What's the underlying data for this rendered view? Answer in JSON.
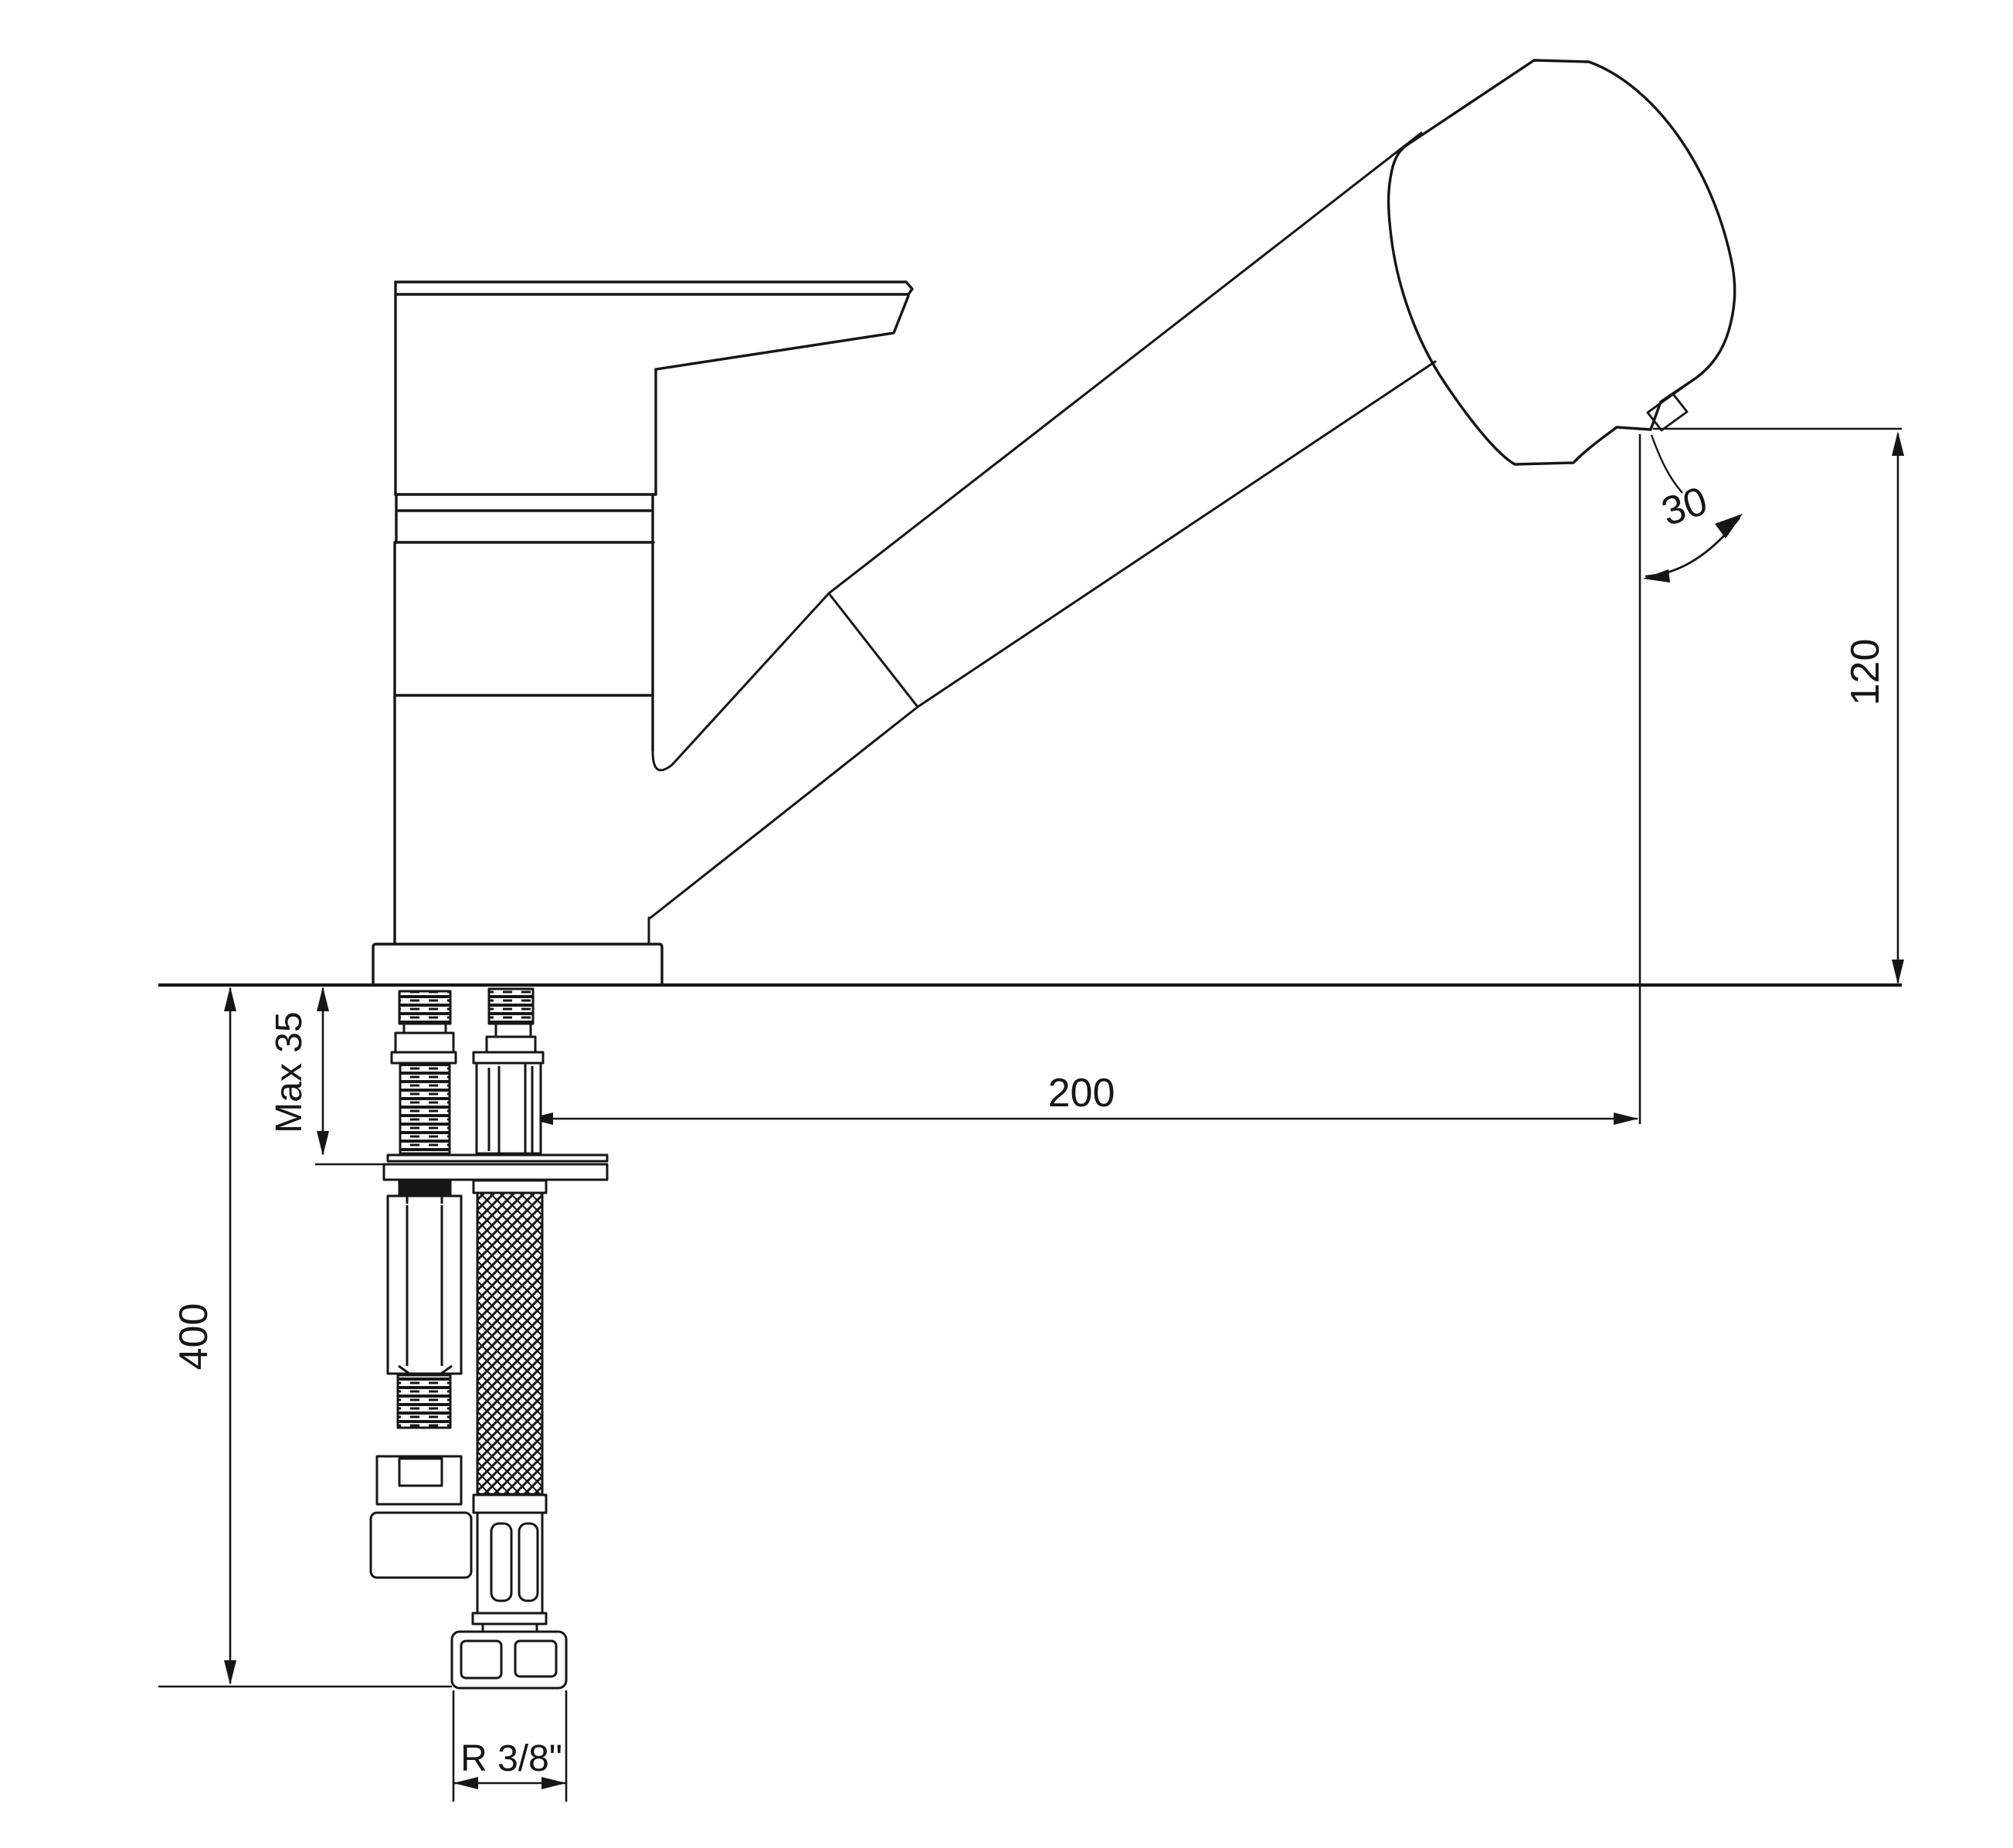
{
  "drawing": {
    "type": "technical dimension drawing",
    "subject": "single-lever kitchen mixer tap with pull-out spray head, side view with installation parts",
    "units_implied": "mm",
    "colors": {
      "line": "#161616",
      "background": "#ffffff"
    },
    "labels": {
      "spray_angle": "30",
      "spout_height": "120",
      "spout_reach": "200",
      "max_deck_thickness": "Max 35",
      "hose_length": "400",
      "connection_thread": "R 3/8\""
    }
  }
}
